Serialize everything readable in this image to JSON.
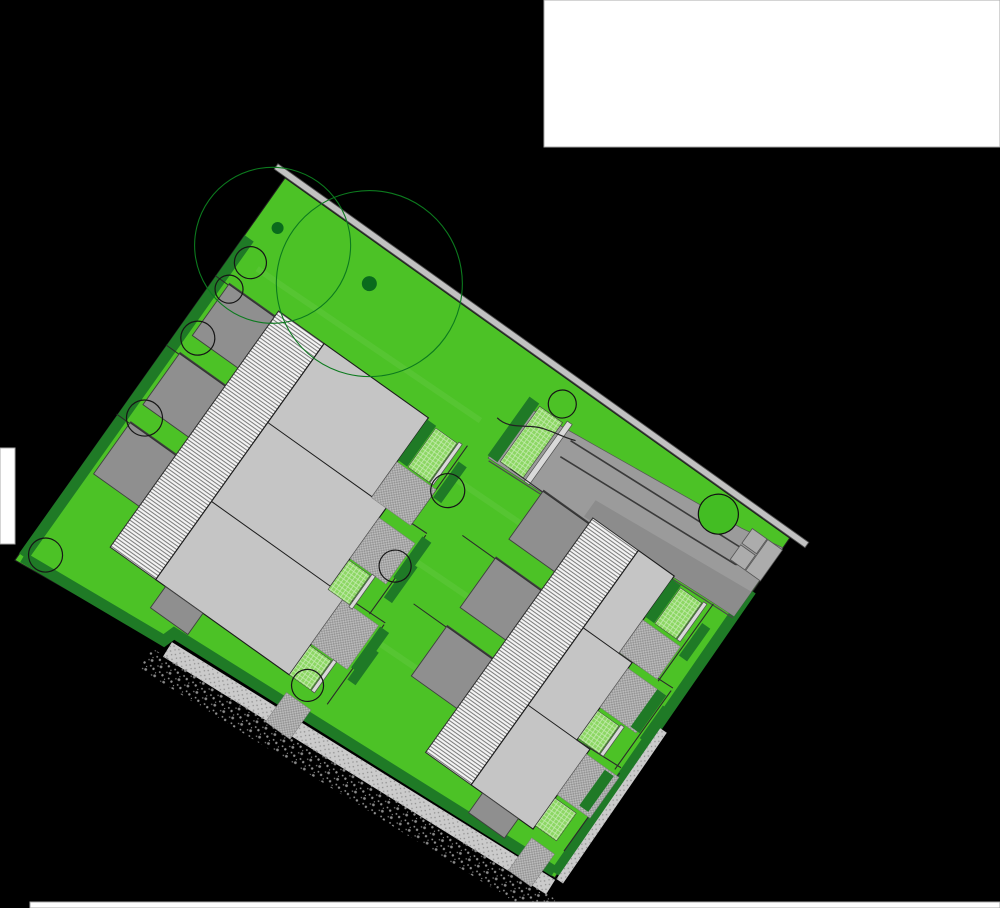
{
  "canvas": {
    "width": 1000,
    "height": 908,
    "background": "#000000"
  },
  "white_patches": [
    {
      "x": 544,
      "y": 0,
      "w": 456,
      "h": 147
    },
    {
      "x": 0,
      "y": 448,
      "w": 15,
      "h": 96
    },
    {
      "x": 30,
      "y": 902,
      "w": 970,
      "h": 6
    }
  ],
  "colors": {
    "lawn": "#4CC226",
    "lawn_streak": "rgba(255,255,255,0.06)",
    "outline": "#1e1e1e",
    "hedge": "#1F7A26",
    "slab": "#C5C5C5",
    "garage": "#8F8F8F",
    "garage_edge": "#333333",
    "road": "#9B9B9B",
    "road_dark": "#8C8C8C",
    "wall_band": "#C2C2C2",
    "wall_edge": "#4F4F4F",
    "small_wall": "#D9D9D9",
    "gravel": "#CBCBCB",
    "fence": "#2a2a2a",
    "tree_green_outline": "#0C7A1E",
    "tree_trunk": "#0A6B1C",
    "tree_black_outline": "#161616",
    "tree_filled": "#43BD23",
    "hairpin": "#3A3A3A",
    "deck_stroke": "#2e2e2e"
  },
  "plan": {
    "origin": {
      "x": 285,
      "y": 178
    },
    "rotation_deg": 35.5,
    "site_polygon": [
      [
        0,
        0
      ],
      [
        620,
        0
      ],
      [
        626,
        413
      ],
      [
        174,
        438
      ],
      [
        169,
        450
      ],
      [
        2,
        468
      ]
    ],
    "lawn_streaks": [
      [
        40,
        152,
        600,
        140
      ],
      [
        60,
        242,
        610,
        230
      ],
      [
        80,
        330,
        615,
        318
      ],
      [
        30,
        90,
        300,
        84
      ]
    ],
    "boundary_wall": {
      "x": -14,
      "y": -7.5,
      "w": 652,
      "h": 6.5
    },
    "hedge_paths": [
      {
        "d": "M6,70 L7,460",
        "w": 11
      },
      {
        "d": "M7,461 L170,447 L174,435 L622,408",
        "w": 11
      },
      {
        "d": "M619,65 L624,409",
        "w": 11
      }
    ],
    "gravel_paths": [
      {
        "d": "M178,452 L628,423",
        "w": 17
      },
      {
        "d": "M629,230 L632,413",
        "w": 8
      }
    ],
    "speckle_path": {
      "d": "M165,472 L640,442",
      "w": 24
    },
    "road": {
      "poly": [
        [
          328,
          46
        ],
        [
          575,
          20
        ],
        [
          620,
          12
        ],
        [
          620,
          96
        ],
        [
          328,
          110
        ]
      ],
      "dark_poly": [
        [
          440,
          82
        ],
        [
          620,
          66
        ],
        [
          620,
          96
        ],
        [
          440,
          102
        ]
      ],
      "hairpin": "M385,48 L589,36 a9,9 0 0 1 2,17 L386,67",
      "squares": [
        [
          584,
          14,
          18,
          18
        ],
        [
          584,
          34,
          18,
          18
        ],
        [
          603,
          14,
          18,
          38
        ]
      ],
      "end_hedge": [
        326,
        36,
        12,
        72
      ],
      "end_hatch": [
        340,
        38,
        28,
        68
      ],
      "end_wall": [
        371,
        34,
        6,
        74
      ],
      "divider": [
        330,
        112,
        620,
        98
      ],
      "wavy": "M312,72 C330,75 341,58 356,54 C368,50 380,49 389,45"
    },
    "rows": [
      {
        "id": "left",
        "garages": [
          [
            16,
            118,
            56,
            64
          ],
          [
            16,
            203,
            56,
            64
          ],
          [
            16,
            288,
            56,
            64
          ]
        ],
        "garage_small": [
          140,
          402,
          46,
          26
        ],
        "rear_fences": [
          [
            0,
            120,
            16,
            120
          ],
          [
            0,
            205,
            16,
            205
          ],
          [
            0,
            290,
            16,
            290
          ]
        ],
        "band": [
          72,
          112,
          56,
          290
        ],
        "slab": [
          [
            128,
            112
          ],
          [
            256,
            112
          ],
          [
            256,
            209
          ],
          [
            274,
            209
          ],
          [
            274,
            306
          ],
          [
            292,
            306
          ],
          [
            292,
            402
          ],
          [
            128,
            402
          ]
        ],
        "unit_lines": [
          [
            128,
            209,
            256,
            209
          ],
          [
            128,
            306,
            274,
            306
          ]
        ],
        "fence_lines": [
          [
            256,
            209,
            322,
            207
          ],
          [
            274,
            306,
            340,
            304
          ],
          [
            304,
            112,
            304,
            209
          ],
          [
            322,
            209,
            322,
            306
          ],
          [
            340,
            306,
            340,
            404
          ]
        ],
        "hedge_segs": [
          [
            256,
            114,
            11,
            50
          ],
          [
            320,
            212,
            11,
            50
          ],
          [
            338,
            310,
            11,
            50
          ],
          [
            306,
            130,
            10,
            44
          ],
          [
            324,
            240,
            10,
            44
          ],
          [
            342,
            332,
            10,
            40
          ]
        ],
        "light_hatches": [
          [
            268,
            116,
            26,
            48
          ],
          [
            274,
            274,
            26,
            36
          ],
          [
            292,
            366,
            26,
            36
          ]
        ],
        "small_walls": [
          [
            295,
            114,
            4,
            50
          ],
          [
            301,
            272,
            4,
            40
          ],
          [
            319,
            364,
            4,
            38
          ]
        ],
        "pavings": [
          [
            256,
            166,
            48,
            44
          ],
          [
            274,
            222,
            44,
            50
          ],
          [
            292,
            310,
            44,
            54
          ],
          [
            300,
            418,
            30,
            36
          ]
        ]
      },
      {
        "id": "right",
        "garages": [
          [
            392,
            104,
            56,
            60
          ],
          [
            392,
            186,
            56,
            62
          ],
          [
            392,
            270,
            56,
            62
          ]
        ],
        "garage_small": [
          518,
          386,
          44,
          24
        ],
        "rear_fences": [
          [
            352,
            106,
            392,
            106
          ],
          [
            352,
            188,
            392,
            188
          ],
          [
            352,
            272,
            392,
            272
          ]
        ],
        "band": [
          448,
          98,
          56,
          288
        ],
        "slab": [
          [
            504,
            98
          ],
          [
            548,
            98
          ],
          [
            548,
            193
          ],
          [
            564,
            193
          ],
          [
            564,
            288
          ],
          [
            580,
            288
          ],
          [
            580,
            386
          ],
          [
            504,
            386
          ]
        ],
        "unit_lines": [
          [
            504,
            193,
            548,
            193
          ],
          [
            504,
            288,
            564,
            288
          ]
        ],
        "fence_lines": [
          [
            548,
            193,
            612,
            190
          ],
          [
            564,
            288,
            616,
            285
          ],
          [
            596,
            98,
            596,
            193
          ],
          [
            612,
            193,
            612,
            290
          ],
          [
            618,
            290,
            618,
            386
          ]
        ],
        "hedge_segs": [
          [
            548,
            102,
            11,
            46
          ],
          [
            600,
            200,
            11,
            46
          ],
          [
            604,
            296,
            11,
            44
          ],
          [
            598,
            120,
            10,
            40
          ],
          [
            614,
            210,
            10,
            40
          ]
        ],
        "light_hatches": [
          [
            560,
            104,
            26,
            44
          ],
          [
            564,
            252,
            26,
            34
          ],
          [
            580,
            348,
            26,
            34
          ]
        ],
        "small_walls": [
          [
            587,
            102,
            4,
            46
          ],
          [
            591,
            250,
            4,
            36
          ]
        ],
        "pavings": [
          [
            548,
            152,
            46,
            40
          ],
          [
            564,
            200,
            44,
            48
          ],
          [
            580,
            294,
            40,
            50
          ],
          [
            584,
            394,
            28,
            40
          ]
        ]
      }
    ],
    "trees": {
      "canopies_green_outline": [
        [
          29,
          62,
          78
        ],
        [
          130,
          37,
          93
        ]
      ],
      "trunks": [
        [
          23,
          45,
          6
        ],
        [
          130,
          37,
          7.5
        ]
      ],
      "canopies_black_outline": [
        [
          21,
          89,
          16
        ],
        [
          19,
          123,
          14
        ],
        [
          22,
          181,
          17
        ],
        [
          25,
          277,
          18
        ],
        [
          24,
          446,
          17
        ],
        [
          314,
          160,
          17
        ],
        [
          315,
          252,
          16
        ],
        [
          313,
          400,
          16
        ],
        [
          357,
          23,
          14
        ]
      ],
      "filled_green": [
        [
          548,
          22,
          20
        ]
      ]
    }
  }
}
